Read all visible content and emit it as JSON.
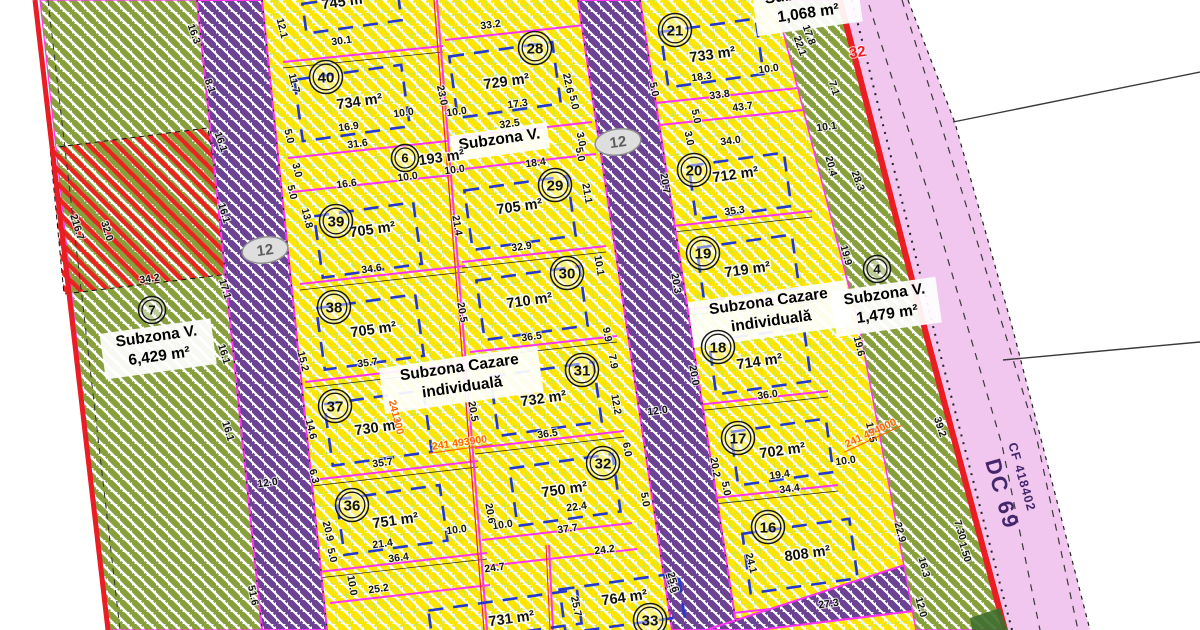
{
  "map": {
    "road": {
      "dc69": "DC 69",
      "cf418402": "CF 418402",
      "marker32": "32",
      "node12": "12"
    },
    "zone_labels": [
      {
        "x": 157,
        "y": 341,
        "w": 112,
        "lines": [
          "Subzona V.",
          "6,429 m²"
        ]
      },
      {
        "x": 500,
        "y": 144,
        "w": 98,
        "lines": [
          "Subzona V."
        ]
      },
      {
        "x": 460,
        "y": 372,
        "w": 160,
        "lines": [
          "Subzona Cazare",
          "individuală"
        ]
      },
      {
        "x": 769,
        "y": 306,
        "w": 160,
        "lines": [
          "Subzona Cazare",
          "individuală"
        ]
      },
      {
        "x": 885,
        "y": 299,
        "w": 106,
        "lines": [
          "Subzona V.",
          "1,479 m²"
        ]
      },
      {
        "x": 806,
        "y": -2,
        "w": 106,
        "lines": [
          "Subzona V.",
          "1,068 m²"
        ]
      }
    ],
    "parcels": [
      {
        "n": "40",
        "cx": 326,
        "cy": 77,
        "a": "734 m²",
        "ax": 360,
        "ay": 106,
        "b": [
          352,
          103,
          108,
          62
        ]
      },
      {
        "n": "39",
        "cx": 336,
        "cy": 221,
        "a": "705 m²",
        "ax": 373,
        "ay": 234,
        "b": [
          368,
          240,
          100,
          62
        ]
      },
      {
        "n": "38",
        "cx": 334,
        "cy": 307,
        "a": "705 m²",
        "ax": 374,
        "ay": 334,
        "b": [
          370,
          332,
          100,
          62
        ]
      },
      {
        "n": "37",
        "cx": 335,
        "cy": 406,
        "a": "730 m²",
        "ax": 378,
        "ay": 432,
        "b": [
          378,
          428,
          100,
          62
        ]
      },
      {
        "n": "36",
        "cx": 352,
        "cy": 505,
        "a": "751 m²",
        "ax": 396,
        "ay": 525,
        "b": [
          392,
          520,
          104,
          56
        ]
      },
      {
        "a": "745 m²",
        "ax": 345,
        "ay": 6,
        "b": [
          352,
          12,
          96,
          30
        ]
      },
      {
        "a": "731 m²",
        "ax": 512,
        "ay": 623,
        "b": [
          505,
          617,
          150,
          34
        ]
      },
      {
        "n": "28",
        "cx": 535,
        "cy": 48,
        "a": "729 m²",
        "ax": 507,
        "ay": 86,
        "b": [
          505,
          80,
          104,
          62
        ]
      },
      {
        "n": "29",
        "cx": 555,
        "cy": 185,
        "a": "705 m²",
        "ax": 520,
        "ay": 211,
        "b": [
          520,
          213,
          104,
          60
        ]
      },
      {
        "n": "30",
        "cx": 567,
        "cy": 273,
        "a": "710 m²",
        "ax": 530,
        "ay": 305,
        "b": [
          532,
          303,
          104,
          60
        ]
      },
      {
        "n": "31",
        "cx": 582,
        "cy": 370,
        "a": "732 m²",
        "ax": 544,
        "ay": 403,
        "b": [
          546,
          399,
          104,
          60
        ]
      },
      {
        "n": "32",
        "cx": 603,
        "cy": 463,
        "a": "750 m²",
        "ax": 565,
        "ay": 494,
        "b": [
          565,
          490,
          104,
          58
        ]
      },
      {
        "n": "33",
        "cx": 650,
        "cy": 620,
        "a": "764 m²",
        "ax": 625,
        "ay": 602,
        "b": [
          622,
          603,
          120,
          44
        ]
      },
      {
        "n": "21",
        "cx": 675,
        "cy": 30,
        "a": "733 m²",
        "ax": 713,
        "ay": 59,
        "b": [
          712,
          53,
          96,
          56
        ]
      },
      {
        "n": "20",
        "cx": 694,
        "cy": 170,
        "a": "712 m²",
        "ax": 736,
        "ay": 179,
        "b": [
          740,
          186,
          96,
          54
        ]
      },
      {
        "n": "19",
        "cx": 703,
        "cy": 253,
        "a": "719 m²",
        "ax": 748,
        "ay": 274,
        "b": [
          748,
          268,
          96,
          54
        ]
      },
      {
        "n": "18",
        "cx": 718,
        "cy": 347,
        "a": "714 m²",
        "ax": 760,
        "ay": 366,
        "b": [
          760,
          361,
          96,
          54
        ]
      },
      {
        "n": "17",
        "cx": 738,
        "cy": 438,
        "a": "702 m²",
        "ax": 783,
        "ay": 455,
        "b": [
          782,
          452,
          96,
          54
        ]
      },
      {
        "n": "16",
        "cx": 768,
        "cy": 527,
        "a": "808 m²",
        "ax": 808,
        "ay": 558,
        "b": [
          800,
          556,
          108,
          60
        ]
      },
      {
        "n": "6",
        "cx": 405,
        "cy": 158,
        "s": 1,
        "a": "193 m²",
        "ax": 442,
        "ay": 162
      },
      {
        "n": "7",
        "cx": 152,
        "cy": 310,
        "s": 1
      },
      {
        "n": "4",
        "cx": 877,
        "cy": 269,
        "s": 1
      }
    ],
    "coordinates": [
      {
        "t": "241300",
        "x": 393,
        "y": 418,
        "r": 76
      },
      {
        "t": "241 493900",
        "x": 460,
        "y": 446,
        "r": -8,
        "u": 1
      },
      {
        "t": "241 494000",
        "x": 872,
        "y": 436,
        "r": -25,
        "u": 1
      }
    ],
    "dimensions": [
      [
        "216.7",
        74,
        228,
        73
      ],
      [
        "32.0",
        104,
        232,
        73
      ],
      [
        "34.2",
        150,
        282,
        -8
      ],
      [
        "16.3",
        191,
        35,
        70
      ],
      [
        "8.1",
        207,
        87,
        70
      ],
      [
        "16.1",
        218,
        143,
        70
      ],
      [
        "16.1",
        221,
        214,
        73
      ],
      [
        "17.1",
        222,
        290,
        73
      ],
      [
        "16.1",
        221,
        355,
        73
      ],
      [
        "16.1",
        225,
        432,
        73
      ],
      [
        "51.6",
        250,
        596,
        78
      ],
      [
        "12.0",
        268,
        486,
        -8
      ],
      [
        "5.0",
        286,
        137,
        76
      ],
      [
        "3.0",
        294,
        171,
        76
      ],
      [
        "13.8",
        304,
        219,
        76
      ],
      [
        "15.2",
        300,
        362,
        76
      ],
      [
        "5.0",
        289,
        193,
        76
      ],
      [
        "14.6",
        308,
        430,
        76
      ],
      [
        "6.3",
        311,
        477,
        76
      ],
      [
        "20.9",
        325,
        532,
        76
      ],
      [
        "5.0",
        329,
        556,
        76
      ],
      [
        "12.1",
        279,
        29,
        76
      ],
      [
        "11.7",
        291,
        84,
        76
      ],
      [
        "30.1",
        342,
        44,
        -8
      ],
      [
        "33.2",
        491,
        28,
        -8
      ],
      [
        "23.0",
        439,
        96,
        78
      ],
      [
        "22.6",
        565,
        84,
        78
      ],
      [
        "5.0",
        571,
        103,
        78
      ],
      [
        "17.3",
        518,
        107,
        -8
      ],
      [
        "16.9",
        349,
        130,
        -8
      ],
      [
        "10.0",
        404,
        116,
        -8
      ],
      [
        "10.0",
        457,
        115,
        -8
      ],
      [
        "32.5",
        510,
        127,
        -8
      ],
      [
        "31.6",
        358,
        147,
        -8
      ],
      [
        "5.0",
        577,
        155,
        78
      ],
      [
        "18.4",
        536,
        166,
        -8
      ],
      [
        "10.0",
        455,
        173,
        -8
      ],
      [
        "10.0",
        408,
        180,
        -8
      ],
      [
        "16.6",
        347,
        187,
        -8
      ],
      [
        "3.0",
        578,
        140,
        78
      ],
      [
        "21.4",
        454,
        226,
        80
      ],
      [
        "21.1",
        584,
        194,
        80
      ],
      [
        "34.6",
        372,
        272,
        -8
      ],
      [
        "32.9",
        522,
        250,
        -8
      ],
      [
        "10.1",
        596,
        266,
        80
      ],
      [
        "20.5",
        459,
        313,
        80
      ],
      [
        "36.5",
        532,
        340,
        -8
      ],
      [
        "35.7",
        368,
        366,
        -8
      ],
      [
        "20.5",
        470,
        412,
        80
      ],
      [
        "12.2",
        613,
        405,
        80
      ],
      [
        "7.9",
        610,
        362,
        80
      ],
      [
        "9.9",
        604,
        335,
        80
      ],
      [
        "36.5",
        548,
        437,
        -8
      ],
      [
        "35.7",
        383,
        466,
        -8
      ],
      [
        "6.0",
        624,
        450,
        80
      ],
      [
        "5.0",
        642,
        500,
        80
      ],
      [
        "22.4",
        577,
        510,
        -8
      ],
      [
        "37.7",
        568,
        532,
        -8
      ],
      [
        "10.0",
        457,
        533,
        -8
      ],
      [
        "10.0",
        503,
        528,
        -8
      ],
      [
        "21.4",
        383,
        547,
        -8
      ],
      [
        "36.4",
        399,
        561,
        -8
      ],
      [
        "20.6",
        487,
        514,
        80
      ],
      [
        "10.0",
        349,
        586,
        80
      ],
      [
        "25.2",
        379,
        592,
        -8
      ],
      [
        "24.7",
        495,
        571,
        -8
      ],
      [
        "24.2",
        605,
        553,
        -8
      ],
      [
        "25.7",
        573,
        607,
        78
      ],
      [
        "23.6",
        668,
        584,
        75
      ],
      [
        "18.3",
        702,
        80,
        -8
      ],
      [
        "10.0",
        769,
        72,
        -8
      ],
      [
        "5.0",
        651,
        90,
        78
      ],
      [
        "33.8",
        720,
        98,
        -8
      ],
      [
        "43.7",
        743,
        110,
        -8
      ],
      [
        "5.0",
        693,
        117,
        78
      ],
      [
        "3.0",
        686,
        139,
        78
      ],
      [
        "17.8",
        806,
        36,
        70
      ],
      [
        "22.1",
        797,
        47,
        70
      ],
      [
        "7.1",
        831,
        89,
        72
      ],
      [
        "10.1",
        827,
        130,
        -8
      ],
      [
        "34.0",
        731,
        144,
        -8
      ],
      [
        "20.7",
        662,
        184,
        80
      ],
      [
        "20.4",
        828,
        167,
        75
      ],
      [
        "28.3",
        855,
        182,
        70
      ],
      [
        "19.9",
        843,
        256,
        75
      ],
      [
        "35.3",
        735,
        214,
        -8
      ],
      [
        "20.3",
        673,
        284,
        80
      ],
      [
        "19.6",
        856,
        347,
        76
      ],
      [
        "20.0",
        691,
        376,
        80
      ],
      [
        "36.0",
        768,
        398,
        -8
      ],
      [
        "12.0",
        658,
        414,
        -8
      ],
      [
        "20.2",
        712,
        468,
        80
      ],
      [
        "5.0",
        723,
        489,
        80
      ],
      [
        "19.4",
        780,
        478,
        -8
      ],
      [
        "10.0",
        846,
        464,
        -8
      ],
      [
        "34.4",
        790,
        492,
        -8
      ],
      [
        "24.1",
        748,
        564,
        75
      ],
      [
        "25.6",
        670,
        583,
        75
      ],
      [
        "27.3",
        829,
        607,
        -8
      ],
      [
        "22.9",
        897,
        533,
        75
      ],
      [
        "39.2",
        937,
        428,
        72
      ],
      [
        "19.5",
        868,
        433,
        78
      ],
      [
        "16.3",
        921,
        568,
        75
      ],
      [
        "12.0",
        918,
        608,
        75
      ],
      [
        "7.30",
        957,
        531,
        73
      ],
      [
        "1.50",
        962,
        553,
        73
      ]
    ]
  }
}
